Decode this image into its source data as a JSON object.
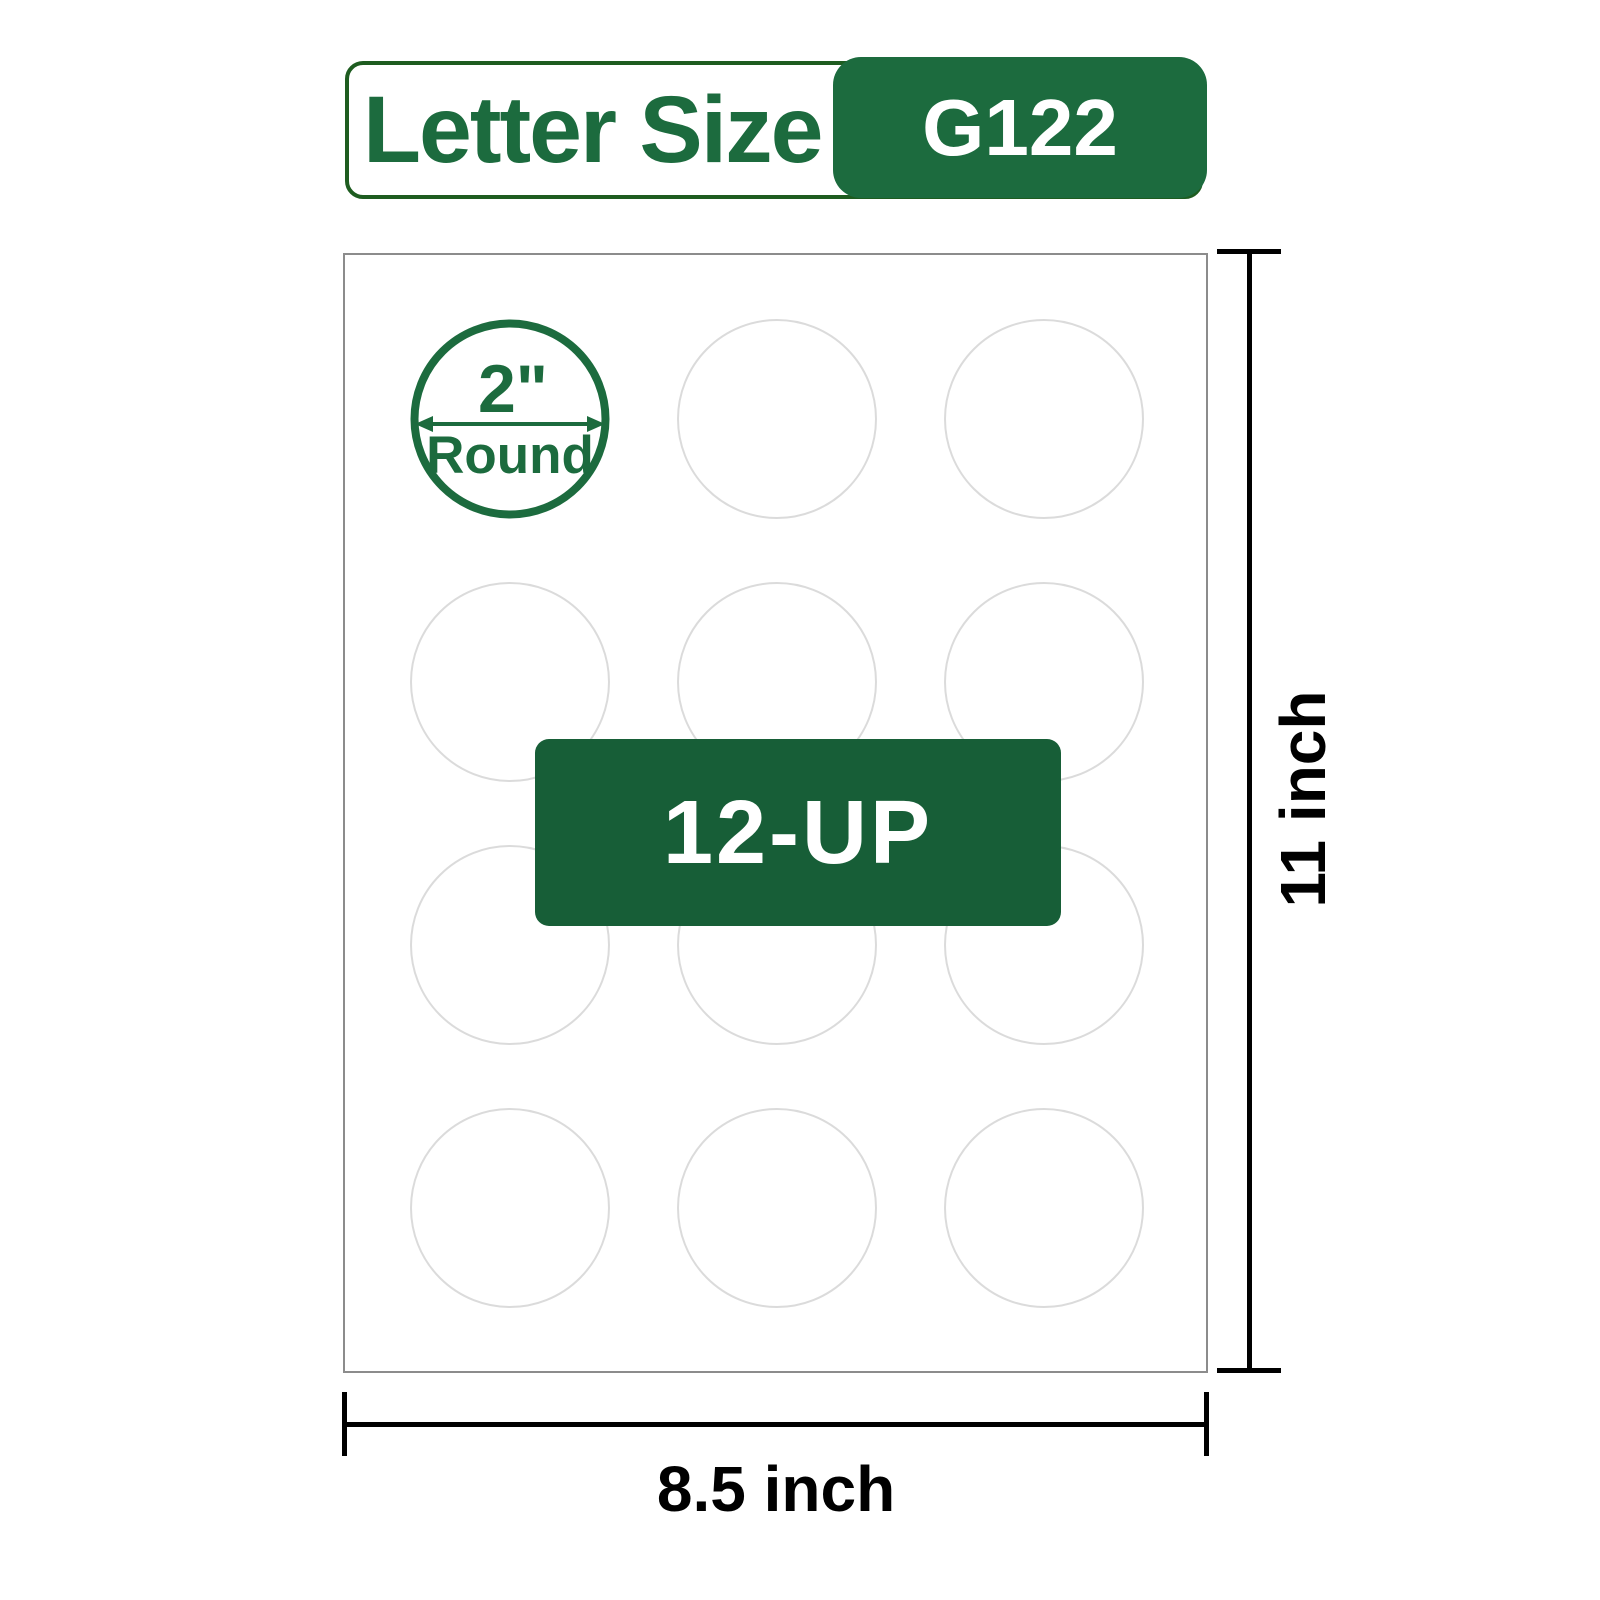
{
  "badge": {
    "size_label": "Letter Size",
    "code": "G122"
  },
  "sheet": {
    "diameter_label": "2\"",
    "shape_label": "Round",
    "count_label": "12-UP",
    "grid": {
      "rows": 4,
      "columns": 3,
      "total_labels": 12
    }
  },
  "dimensions": {
    "height_label": "11 inch",
    "width_label": "8.5 inch"
  },
  "colors": {
    "brand_green": "#1c6b3e",
    "badge_dark_green": "#175e37",
    "pill_border_green": "#1e5c20",
    "circle_outline_gray": "#dbdbdb",
    "sheet_border_gray": "#8c8c8c",
    "dimension_black": "#000000"
  }
}
